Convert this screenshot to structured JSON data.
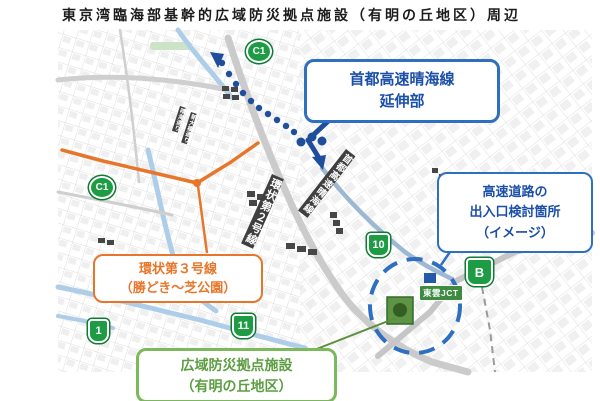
{
  "title": "東京湾臨海部基幹的広域防災拠点施設（有明の丘地区）周辺",
  "callouts": {
    "harumi_extension": {
      "lines": [
        "首都高速晴海線",
        "延伸部"
      ]
    },
    "exit_study": {
      "lines": [
        "高速道路の",
        "出入口検討箇所",
        "（イメージ）"
      ]
    },
    "ring_road_3": {
      "lines": [
        "環状第３号線",
        "（勝どき～芝公園）"
      ]
    },
    "disaster_base": {
      "lines": [
        "広域防災拠点施設",
        "（有明の丘地区）"
      ]
    }
  },
  "map_labels": {
    "ring_road_2": "環状第２号線",
    "harumi_line": "首都高速晴海線",
    "shinonome_jct": "東雲JCT",
    "harumi_street": "晴海通り",
    "shin_ohashi_street": "新大橋通り"
  },
  "route_markers": [
    {
      "id": "c1-top",
      "label": "C1"
    },
    {
      "id": "c1-left",
      "label": "C1"
    },
    {
      "id": "route-1",
      "label": "1"
    },
    {
      "id": "route-11",
      "label": "11"
    },
    {
      "id": "route-10",
      "label": "10"
    },
    {
      "id": "route-b",
      "label": "B"
    }
  ],
  "colors": {
    "callout_blue": "#2e6fc0",
    "route_blue": "#1f4e9c",
    "orange": "#e8762a",
    "callout_green": "#7cb85c",
    "marker_green": "#1d9c44",
    "existing_line_blue": "#9db8d2"
  }
}
